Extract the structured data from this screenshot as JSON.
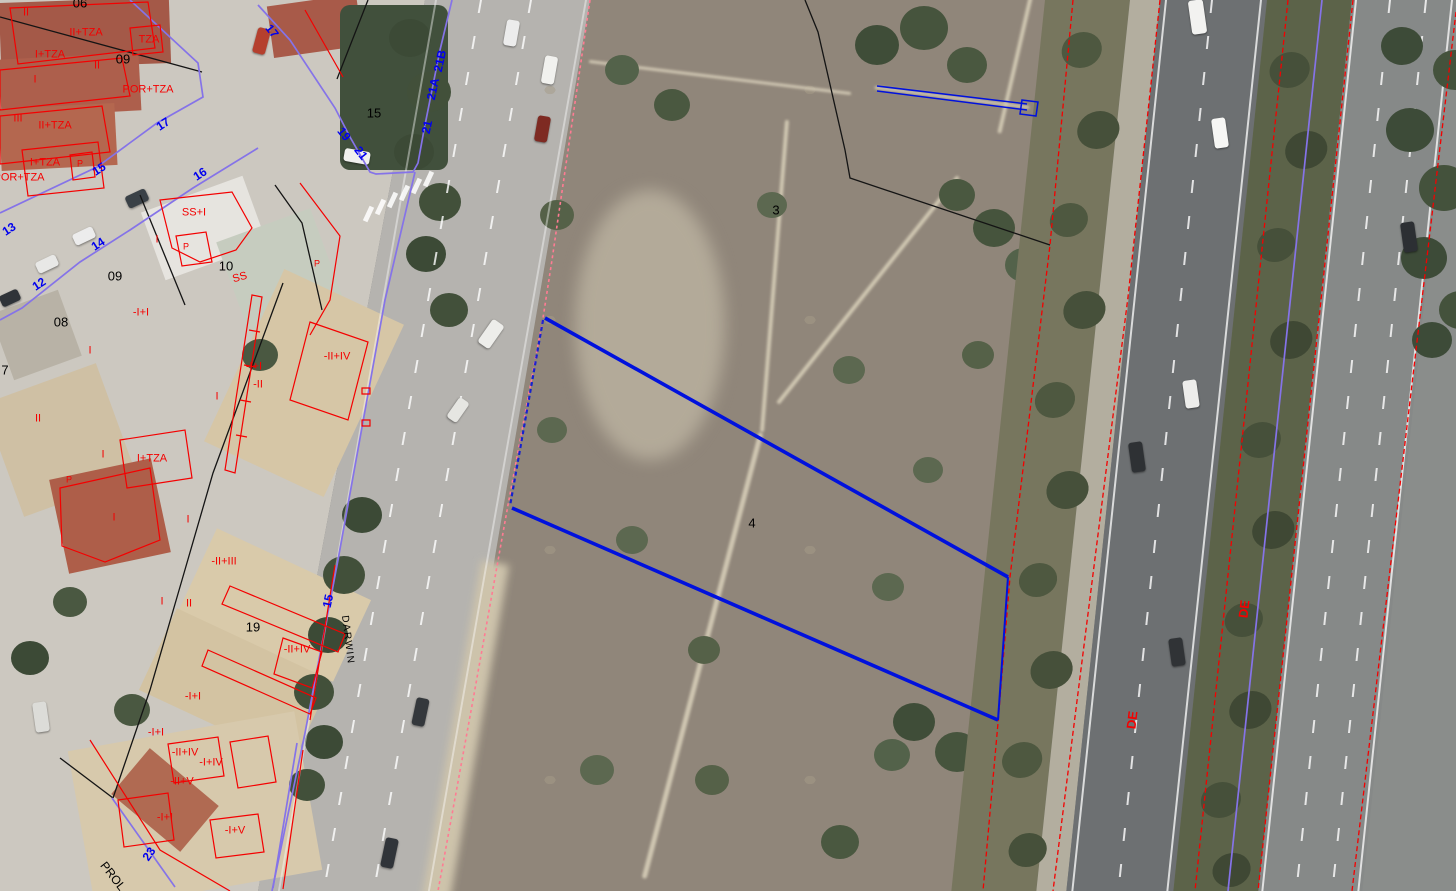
{
  "colors": {
    "overlay_red": "#f40000",
    "street_number_blue": "#0000ee",
    "boundary_purple": "#8573e8",
    "selection_blue": "#0011dd",
    "road_edge_pink": "#ff7b93",
    "line_black": "#141414",
    "label_black": "#000000"
  },
  "labels": [
    {
      "name": "height-code-label",
      "kind": "red",
      "text": "II",
      "x": 26,
      "y": 13
    },
    {
      "name": "height-code-label",
      "kind": "red",
      "text": "II+TZA",
      "x": 86,
      "y": 33
    },
    {
      "name": "height-code-label",
      "kind": "red",
      "text": "TZA",
      "x": 149,
      "y": 40
    },
    {
      "name": "height-code-label",
      "kind": "red",
      "text": "I+TZA",
      "x": 50,
      "y": 55
    },
    {
      "name": "height-code-label",
      "kind": "red",
      "text": "II",
      "x": 97,
      "y": 66
    },
    {
      "name": "height-code-label",
      "kind": "red",
      "text": "POR+TZA",
      "x": 148,
      "y": 90
    },
    {
      "name": "height-code-label",
      "kind": "red",
      "text": "I",
      "x": 35,
      "y": 80
    },
    {
      "name": "height-code-label",
      "kind": "red",
      "text": "III",
      "x": 18,
      "y": 119
    },
    {
      "name": "height-code-label",
      "kind": "red",
      "text": "II+TZA",
      "x": 55,
      "y": 126
    },
    {
      "name": "height-code-label",
      "kind": "red",
      "text": "I+TZA",
      "x": 45,
      "y": 163
    },
    {
      "name": "height-code-label",
      "kind": "red",
      "text": "P",
      "x": 80,
      "y": 164,
      "fs": 9
    },
    {
      "name": "height-code-label",
      "kind": "red",
      "text": "POR+TZA",
      "x": 19,
      "y": 178
    },
    {
      "name": "height-code-label",
      "kind": "red",
      "text": "SS+I",
      "x": 194,
      "y": 213
    },
    {
      "name": "height-code-label",
      "kind": "red",
      "text": "I",
      "x": 157,
      "y": 240
    },
    {
      "name": "height-code-label",
      "kind": "red",
      "text": "P",
      "x": 186,
      "y": 247,
      "fs": 9
    },
    {
      "name": "height-code-label",
      "kind": "red",
      "text": "SS",
      "x": 240,
      "y": 278,
      "rot": -15
    },
    {
      "name": "height-code-label",
      "kind": "red",
      "text": "P",
      "x": 317,
      "y": 264,
      "fs": 9
    },
    {
      "name": "height-code-label",
      "kind": "red",
      "text": "-I+I",
      "x": 141,
      "y": 313
    },
    {
      "name": "height-code-label",
      "kind": "red",
      "text": "I",
      "x": 90,
      "y": 351
    },
    {
      "name": "height-code-label",
      "kind": "red",
      "text": "II",
      "x": 38,
      "y": 419
    },
    {
      "name": "height-code-label",
      "kind": "red",
      "text": "I",
      "x": 103,
      "y": 455
    },
    {
      "name": "height-code-label",
      "kind": "red",
      "text": "I+TZA",
      "x": 152,
      "y": 459
    },
    {
      "name": "height-code-label",
      "kind": "red",
      "text": "P",
      "x": 69,
      "y": 480,
      "fs": 9
    },
    {
      "name": "height-code-label",
      "kind": "red",
      "text": "I",
      "x": 114,
      "y": 518
    },
    {
      "name": "height-code-label",
      "kind": "red",
      "text": "I",
      "x": 188,
      "y": 520
    },
    {
      "name": "height-code-label",
      "kind": "red",
      "text": "I",
      "x": 217,
      "y": 397
    },
    {
      "name": "height-code-label",
      "kind": "red",
      "text": "-II+III",
      "x": 224,
      "y": 562
    },
    {
      "name": "height-code-label",
      "kind": "red",
      "text": "-I+I",
      "x": 254,
      "y": 367
    },
    {
      "name": "height-code-label",
      "kind": "red",
      "text": "-II",
      "x": 258,
      "y": 385
    },
    {
      "name": "height-code-label",
      "kind": "red",
      "text": "-II+IV",
      "x": 337,
      "y": 357
    },
    {
      "name": "height-code-label",
      "kind": "red",
      "text": "I",
      "x": 162,
      "y": 602
    },
    {
      "name": "height-code-label",
      "kind": "red",
      "text": "II",
      "x": 189,
      "y": 604
    },
    {
      "name": "height-code-label",
      "kind": "red",
      "text": "-II+IV",
      "x": 297,
      "y": 650
    },
    {
      "name": "height-code-label",
      "kind": "red",
      "text": "-I+I",
      "x": 193,
      "y": 697
    },
    {
      "name": "height-code-label",
      "kind": "red",
      "text": "-I+I",
      "x": 156,
      "y": 733
    },
    {
      "name": "height-code-label",
      "kind": "red",
      "text": "-II+IV",
      "x": 185,
      "y": 753
    },
    {
      "name": "height-code-label",
      "kind": "red",
      "text": "-I+IV",
      "x": 211,
      "y": 763
    },
    {
      "name": "height-code-label",
      "kind": "red",
      "text": "-II+V",
      "x": 182,
      "y": 782
    },
    {
      "name": "height-code-label",
      "kind": "red",
      "text": "-I+I",
      "x": 165,
      "y": 818
    },
    {
      "name": "height-code-label",
      "kind": "red",
      "text": "-I+V",
      "x": 235,
      "y": 831
    },
    {
      "name": "road-name-de",
      "kind": "red",
      "text": "DE",
      "x": 1132,
      "y": 720,
      "rot": -83,
      "fs": 13,
      "b": 1
    },
    {
      "name": "road-name-de",
      "kind": "red",
      "text": "DE",
      "x": 1244,
      "y": 609,
      "rot": -83,
      "fs": 13,
      "b": 1
    },
    {
      "name": "street-number-label",
      "kind": "blue",
      "text": "17",
      "x": 163,
      "y": 124,
      "rot": -33
    },
    {
      "name": "street-number-label",
      "kind": "blue",
      "text": "15",
      "x": 99,
      "y": 169,
      "rot": -33
    },
    {
      "name": "street-number-label",
      "kind": "blue",
      "text": "16",
      "x": 200,
      "y": 174,
      "rot": -33
    },
    {
      "name": "street-number-label",
      "kind": "blue",
      "text": "13",
      "x": 9,
      "y": 229,
      "rot": -33
    },
    {
      "name": "street-number-label",
      "kind": "blue",
      "text": "14",
      "x": 98,
      "y": 244,
      "rot": -33
    },
    {
      "name": "street-number-label",
      "kind": "blue",
      "text": "12",
      "x": 39,
      "y": 284,
      "rot": -33
    },
    {
      "name": "street-number-label",
      "kind": "blue",
      "text": "17",
      "x": 272,
      "y": 31,
      "rot": 52
    },
    {
      "name": "street-number-label",
      "kind": "blue",
      "text": "19",
      "x": 344,
      "y": 134,
      "rot": 52
    },
    {
      "name": "street-number-label",
      "kind": "blue",
      "text": "21",
      "x": 361,
      "y": 153,
      "rot": 52
    },
    {
      "name": "street-number-label",
      "kind": "blue",
      "text": "21",
      "x": 427,
      "y": 127,
      "rot": -78
    },
    {
      "name": "street-number-label",
      "kind": "blue",
      "text": "21A",
      "x": 433,
      "y": 89,
      "rot": -78
    },
    {
      "name": "street-number-label",
      "kind": "blue",
      "text": "21B",
      "x": 440,
      "y": 61,
      "rot": -78
    },
    {
      "name": "street-number-label",
      "kind": "blue",
      "text": "15",
      "x": 328,
      "y": 601,
      "rot": -78
    },
    {
      "name": "street-number-label",
      "kind": "blue",
      "text": "23",
      "x": 149,
      "y": 854,
      "rot": -55
    },
    {
      "name": "block-number-label",
      "kind": "black",
      "text": "06",
      "x": 80,
      "y": 3
    },
    {
      "name": "block-number-label",
      "kind": "black",
      "text": "09",
      "x": 123,
      "y": 59
    },
    {
      "name": "block-number-label",
      "kind": "black",
      "text": "15",
      "x": 374,
      "y": 113
    },
    {
      "name": "block-number-label",
      "kind": "black",
      "text": "09",
      "x": 115,
      "y": 276
    },
    {
      "name": "block-number-label",
      "kind": "black",
      "text": "10",
      "x": 226,
      "y": 266
    },
    {
      "name": "block-number-label",
      "kind": "black",
      "text": "08",
      "x": 61,
      "y": 322
    },
    {
      "name": "block-number-label",
      "kind": "black",
      "text": "7",
      "x": 5,
      "y": 370
    },
    {
      "name": "block-number-label",
      "kind": "black",
      "text": "19",
      "x": 253,
      "y": 627
    },
    {
      "name": "parcel-number-3",
      "kind": "black",
      "text": "3",
      "x": 776,
      "y": 210
    },
    {
      "name": "parcel-number-4",
      "kind": "black",
      "text": "4",
      "x": 752,
      "y": 523
    },
    {
      "name": "street-name-darwin",
      "kind": "black",
      "text": "DARWIN",
      "x": 347,
      "y": 640,
      "rot": 83,
      "fs": 10,
      "ls": 1.5
    },
    {
      "name": "street-name-prol",
      "kind": "black",
      "text": "PROL",
      "x": 113,
      "y": 876,
      "rot": 52,
      "fs": 12
    }
  ],
  "cars": [
    {
      "x": 505,
      "y": 20,
      "w": 13,
      "h": 26,
      "rot": 10,
      "c": "#ececec"
    },
    {
      "x": 543,
      "y": 56,
      "w": 13,
      "h": 28,
      "rot": 10,
      "c": "#f1f1ee"
    },
    {
      "x": 536,
      "y": 116,
      "w": 13,
      "h": 26,
      "rot": 10,
      "c": "#7e2a22"
    },
    {
      "x": 344,
      "y": 150,
      "w": 26,
      "h": 13,
      "rot": 10,
      "c": "#f0f0ed"
    },
    {
      "x": 484,
      "y": 320,
      "w": 14,
      "h": 28,
      "rot": 35,
      "c": "#ededea"
    },
    {
      "x": 452,
      "y": 398,
      "w": 12,
      "h": 24,
      "rot": 35,
      "c": "#e6e6e2"
    },
    {
      "x": 414,
      "y": 698,
      "w": 13,
      "h": 28,
      "rot": 12,
      "c": "#34383c"
    },
    {
      "x": 383,
      "y": 838,
      "w": 13,
      "h": 30,
      "rot": 12,
      "c": "#303439"
    },
    {
      "x": 255,
      "y": 28,
      "w": 13,
      "h": 26,
      "rot": 15,
      "c": "#b5402e"
    },
    {
      "x": 126,
      "y": 192,
      "w": 22,
      "h": 13,
      "rot": -25,
      "c": "#3a4147"
    },
    {
      "x": 73,
      "y": 230,
      "w": 22,
      "h": 12,
      "rot": -25,
      "c": "#ececec"
    },
    {
      "x": 36,
      "y": 258,
      "w": 22,
      "h": 12,
      "rot": -25,
      "c": "#e8e8e6"
    },
    {
      "x": 0,
      "y": 292,
      "w": 20,
      "h": 12,
      "rot": -25,
      "c": "#2f3338"
    },
    {
      "x": 34,
      "y": 702,
      "w": 14,
      "h": 30,
      "rot": -8,
      "c": "#dcdcd8"
    },
    {
      "x": 1190,
      "y": 0,
      "w": 15,
      "h": 34,
      "rot": -8,
      "c": "#f2f2f0"
    },
    {
      "x": 1213,
      "y": 118,
      "w": 14,
      "h": 30,
      "rot": -8,
      "c": "#f6f6f4"
    },
    {
      "x": 1184,
      "y": 380,
      "w": 14,
      "h": 28,
      "rot": -8,
      "c": "#ededeb"
    },
    {
      "x": 1130,
      "y": 442,
      "w": 14,
      "h": 30,
      "rot": -8,
      "c": "#2e3134"
    },
    {
      "x": 1170,
      "y": 638,
      "w": 14,
      "h": 28,
      "rot": -8,
      "c": "#303336"
    },
    {
      "x": 1402,
      "y": 222,
      "w": 14,
      "h": 30,
      "rot": -8,
      "c": "#2c2f33"
    }
  ]
}
